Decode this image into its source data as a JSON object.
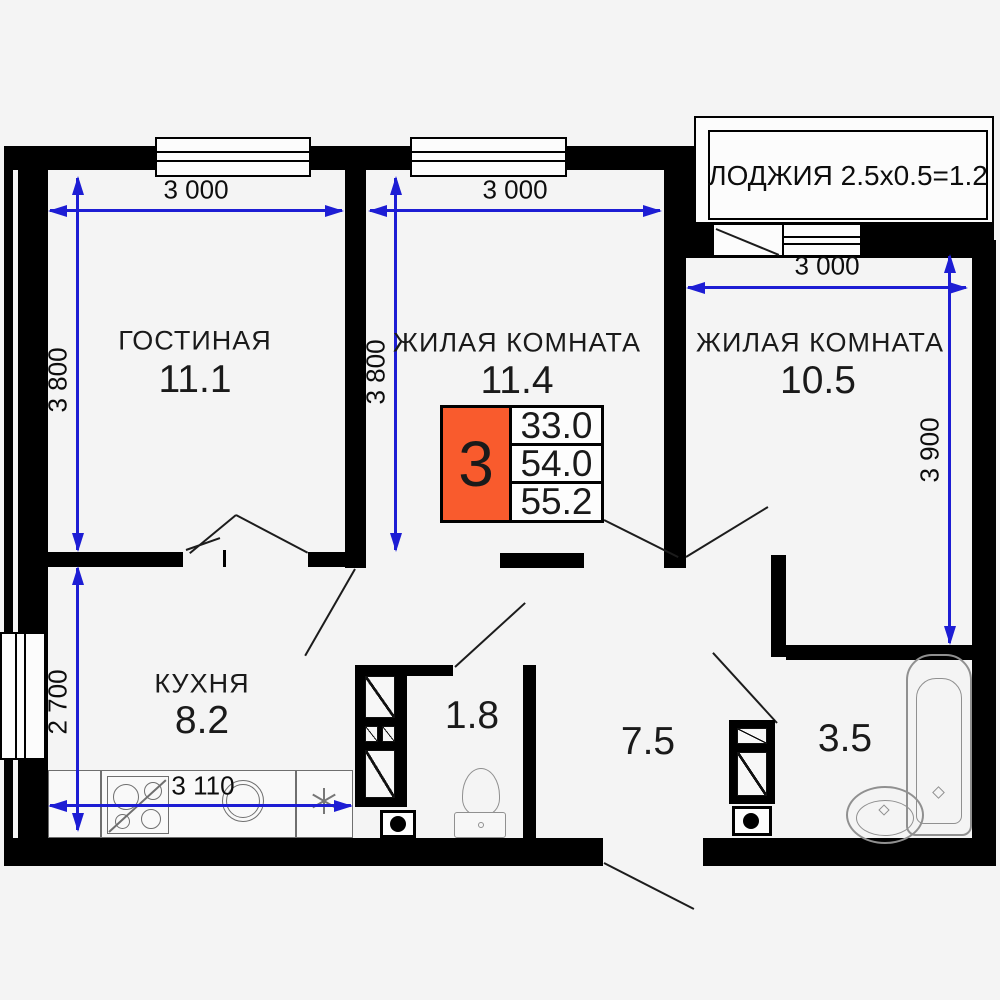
{
  "colors": {
    "wall": "#000000",
    "dimension_blue": "#1d1dd4",
    "legend_orange": "#f95b2d",
    "background": "#f4f4f4"
  },
  "loggia": {
    "label": "ЛОДЖИЯ 2.5x0.5=1.2"
  },
  "legend": {
    "count": "3",
    "row1": "33.0",
    "row2": "54.0",
    "row3": "55.2"
  },
  "rooms": {
    "living": {
      "name": "ГОСТИНАЯ",
      "area": "11.1"
    },
    "bedroom_mid": {
      "name": "ЖИЛАЯ КОМНАТА",
      "area": "11.4"
    },
    "bedroom_right": {
      "name": "ЖИЛАЯ КОМНАТА",
      "area": "10.5"
    },
    "kitchen": {
      "name": "КУХНЯ",
      "area": "8.2"
    },
    "wc": {
      "area": "1.8"
    },
    "hallway": {
      "area": "7.5"
    },
    "bathroom": {
      "area": "3.5"
    }
  },
  "dimensions": {
    "living_w": "3 000",
    "living_h": "3 800",
    "bedroom_mid_w": "3 000",
    "bedroom_mid_h": "3 800",
    "bedroom_right_w": "3 000",
    "bedroom_right_h": "3 900",
    "kitchen_w": "3 110",
    "kitchen_h": "2 700"
  }
}
